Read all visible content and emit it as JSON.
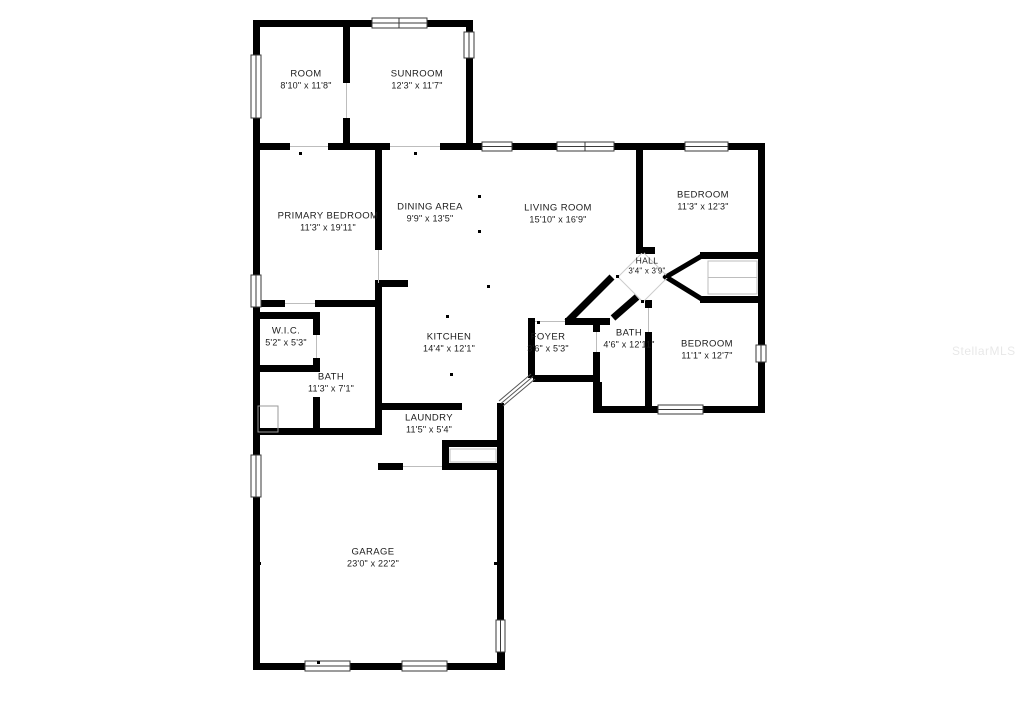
{
  "watermark": "StellarMLS",
  "rooms": {
    "room": {
      "name": "ROOM",
      "dims": "8'10\" x 11'8\""
    },
    "sunroom": {
      "name": "SUNROOM",
      "dims": "12'3\" x 11'7\""
    },
    "primary": {
      "name": "PRIMARY BEDROOM",
      "dims": "11'3\" x 19'11\""
    },
    "dining": {
      "name": "DINING AREA",
      "dims": "9'9\" x 13'5\""
    },
    "living": {
      "name": "LIVING ROOM",
      "dims": "15'10\" x 16'9\""
    },
    "bedroom2": {
      "name": "BEDROOM",
      "dims": "11'3\" x 12'3\""
    },
    "hall": {
      "name": "HALL",
      "dims": "3'4\" x 3'9\""
    },
    "bath2": {
      "name": "BATH",
      "dims": "4'6\" x 12'11\""
    },
    "bedroom3": {
      "name": "BEDROOM",
      "dims": "11'1\" x 12'7\""
    },
    "wic": {
      "name": "W.I.C.",
      "dims": "5'2\" x 5'3\""
    },
    "bath1": {
      "name": "BATH",
      "dims": "11'3\" x 7'1\""
    },
    "kitchen": {
      "name": "KITCHEN",
      "dims": "14'4\" x 12'1\""
    },
    "foyer": {
      "name": "FOYER",
      "dims": "3'6\" x 5'3\""
    },
    "laundry": {
      "name": "LAUNDRY",
      "dims": "11'5\" x 5'4\""
    },
    "garage": {
      "name": "GARAGE",
      "dims": "23'0\" x 22'2\""
    }
  }
}
